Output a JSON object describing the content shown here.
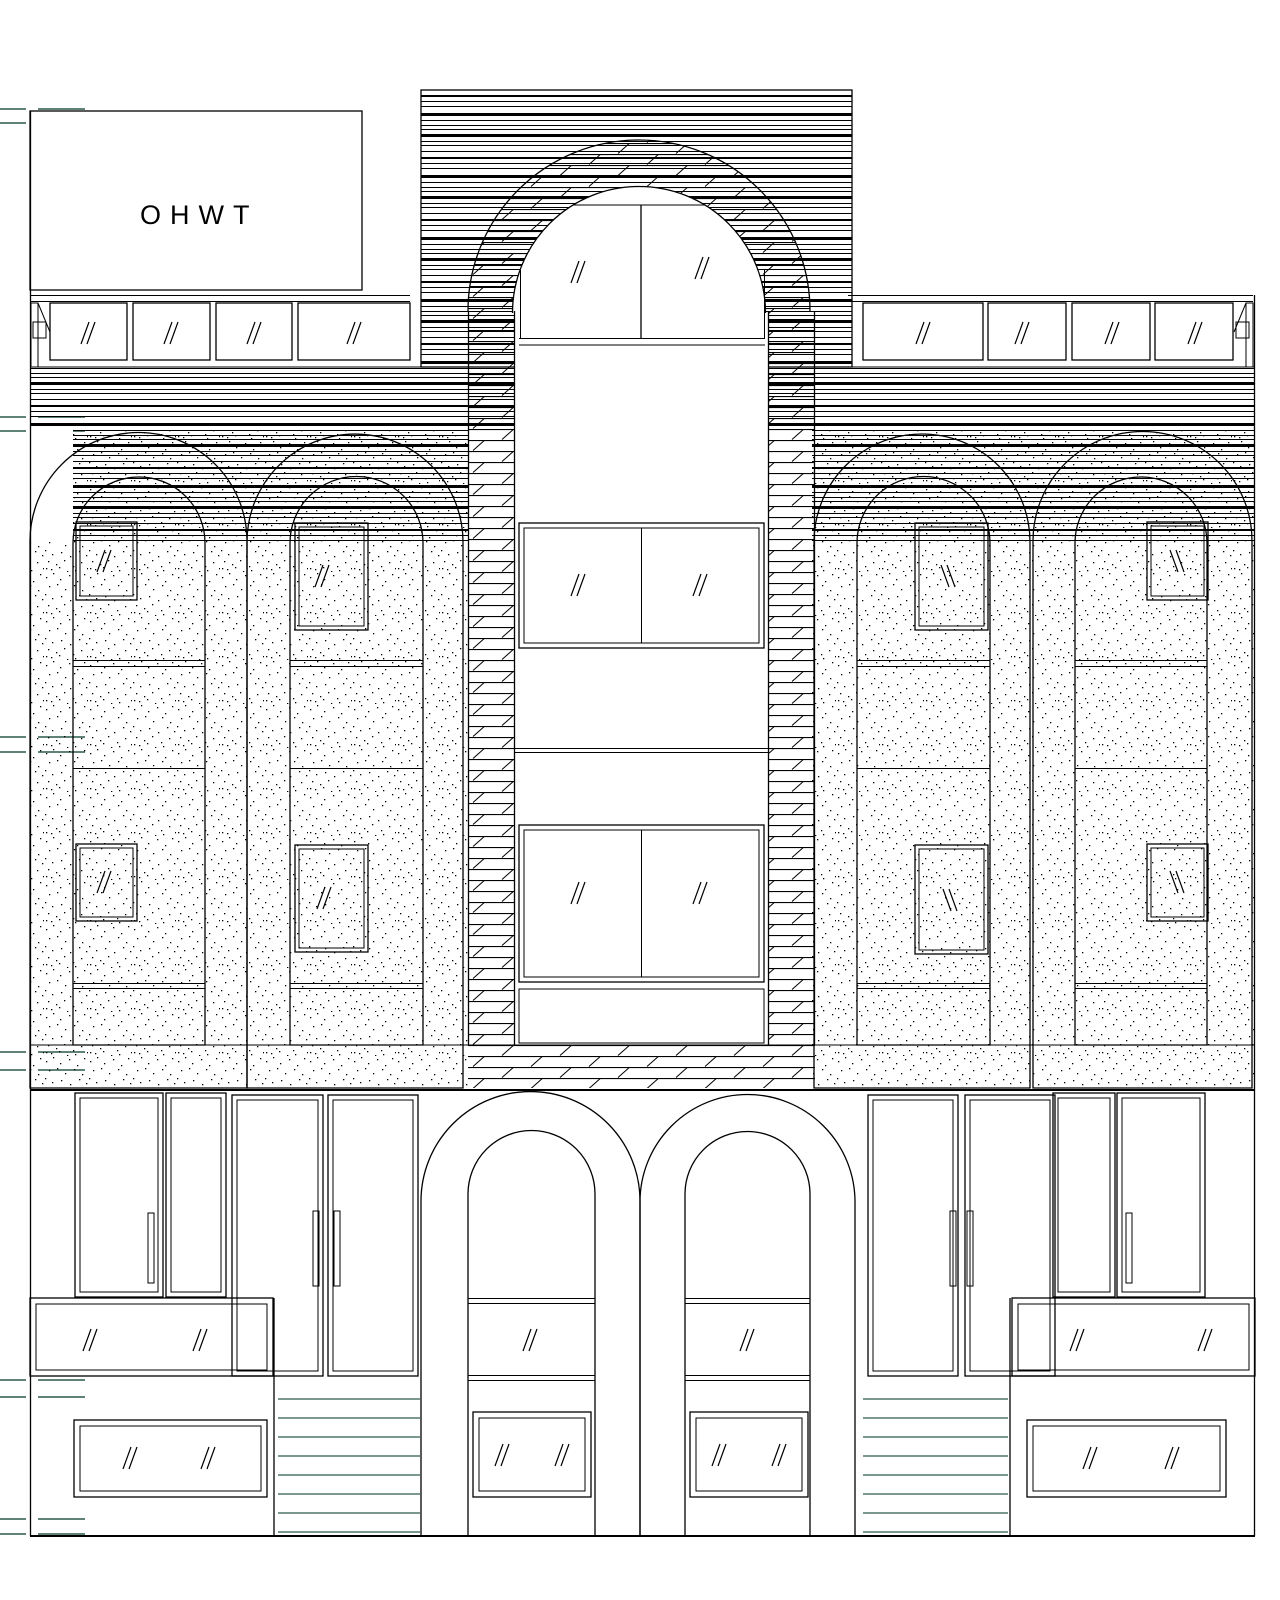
{
  "page": {
    "background": "#ffffff"
  },
  "colors": {
    "line": "#000000",
    "annotation_green": "#2a5a49",
    "paper": "#ffffff"
  },
  "signage": {
    "label": "OHWT"
  },
  "symbols": {
    "glass_pane_mark": "//"
  }
}
